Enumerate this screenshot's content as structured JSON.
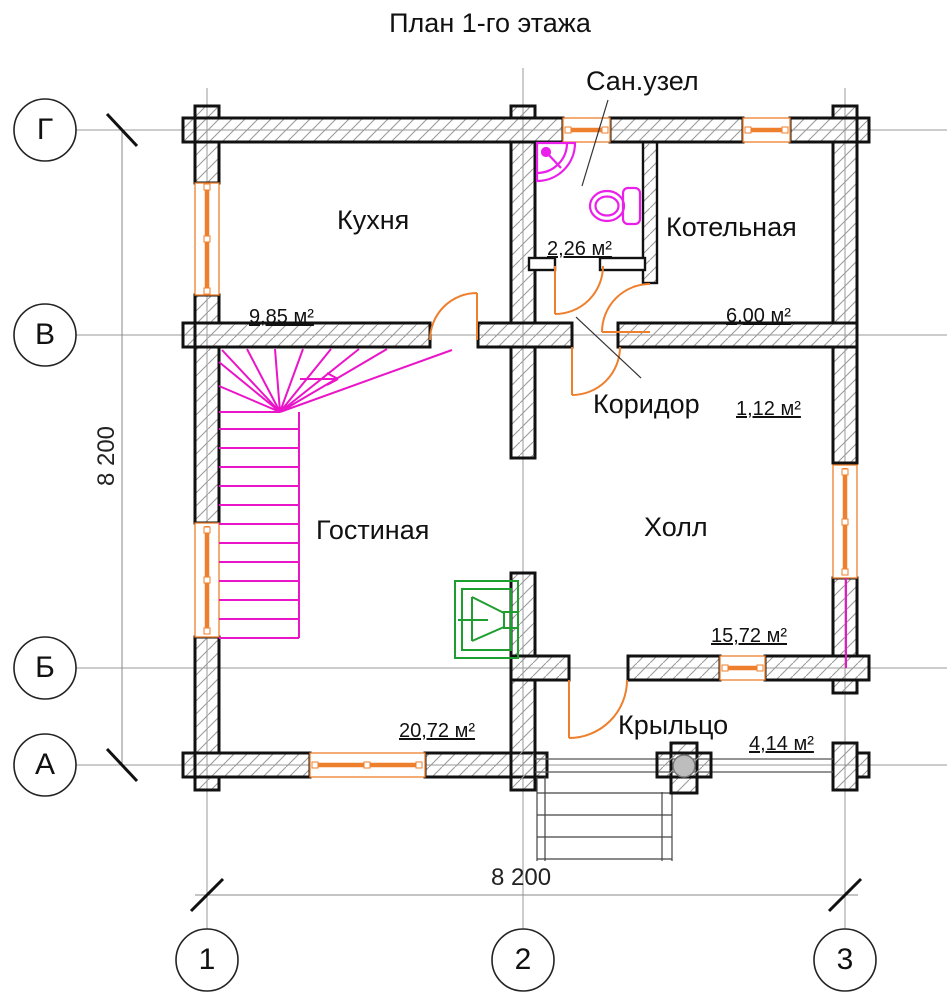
{
  "title": "План 1-го этажа",
  "rooms": {
    "kitchen": {
      "name": "Кухня",
      "area": "9,85 м²"
    },
    "bathroom": {
      "name": "Сан.узел",
      "area": "2,26 м²"
    },
    "boiler": {
      "name": "Котельная",
      "area": "6,00 м²"
    },
    "corridor": {
      "name": "Коридор",
      "area": "1,12 м²"
    },
    "living": {
      "name": "Гостиная",
      "area": "20,72 м²"
    },
    "hall": {
      "name": "Холл",
      "area": "15,72 м²"
    },
    "porch": {
      "name": "Крыльцо",
      "area": "4,14 м²"
    }
  },
  "axes": {
    "rows": [
      "Г",
      "В",
      "Б",
      "А"
    ],
    "cols": [
      "1",
      "2",
      "3"
    ]
  },
  "dimensions": {
    "horizontal": "8 200",
    "vertical": "8 200"
  },
  "colors": {
    "wall_outline": "#111111",
    "hatch": "#9b9b9b",
    "grid": "#999999",
    "windows_doors_orange": "#ee7f2d",
    "stairs_fixtures_magenta": "#ea14c8",
    "fireplace_green": "#1f9e30",
    "column_gray": "#bdbdbd"
  }
}
